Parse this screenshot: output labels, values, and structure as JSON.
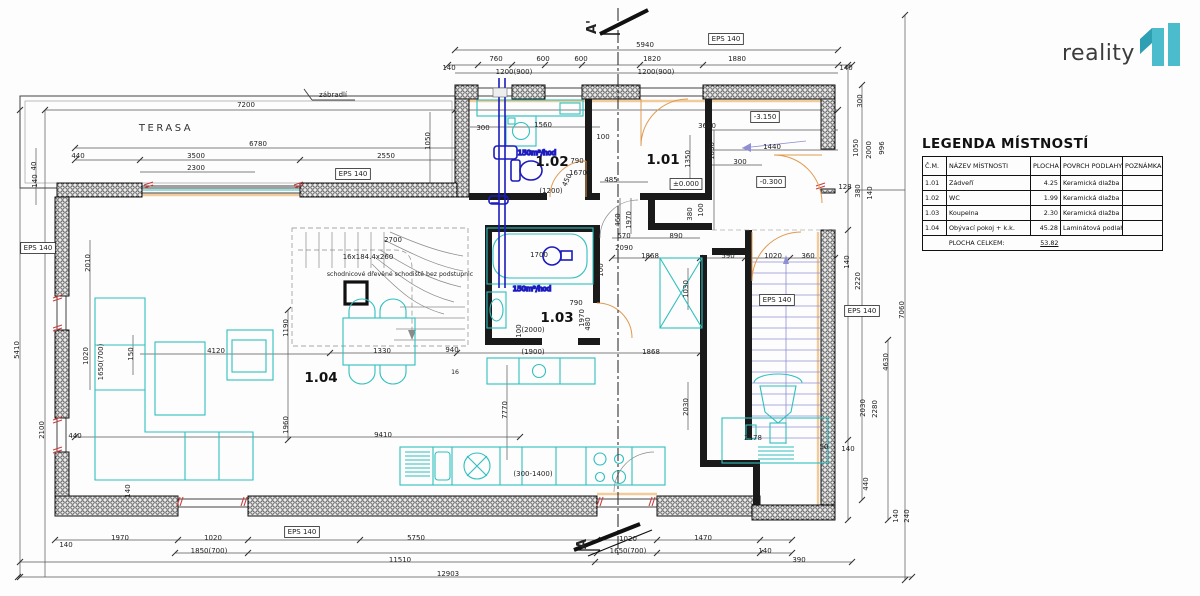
{
  "logo": {
    "text": "reality",
    "brand_color": "#4abccb",
    "flag_color": "#2f9fb4",
    "text_color": "#3c3c3c"
  },
  "legend": {
    "title": "LEGENDA MÍSTNOSTÍ",
    "headers": [
      "Č.M.",
      "NÁZEV MÍSTNOSTI",
      "PLOCHA [m2]",
      "POVRCH PODLAHY",
      "POZNÁMKA"
    ],
    "rows": [
      {
        "cm": "1.01",
        "nazev": "Zádveří",
        "plocha": "4.25",
        "povrch": "Keramická dlažba",
        "poznamka": ""
      },
      {
        "cm": "1.02",
        "nazev": "WC",
        "plocha": "1.99",
        "povrch": "Keramická dlažba",
        "poznamka": ""
      },
      {
        "cm": "1.03",
        "nazev": "Koupelna",
        "plocha": "2.30",
        "povrch": "Keramická dlažba",
        "poznamka": ""
      },
      {
        "cm": "1.04",
        "nazev": "Obývací pokoj + k.k.",
        "plocha": "45.28",
        "povrch": "Laminátová podlaha",
        "poznamka": ""
      }
    ],
    "total_label": "PLOCHA CELKEM:",
    "total_value": "53.82"
  },
  "annotations": [
    {
      "t": "A'",
      "x": 596,
      "y": 27,
      "rot": -90,
      "cls": "section",
      "name": "section-marker-label-top"
    },
    {
      "t": "A",
      "x": 586,
      "y": 544,
      "rot": -90,
      "cls": "section",
      "name": "section-marker-label-bottom"
    },
    {
      "t": "5940",
      "x": 645,
      "y": 47
    },
    {
      "t": "760",
      "x": 496,
      "y": 61
    },
    {
      "t": "600",
      "x": 543,
      "y": 61
    },
    {
      "t": "600",
      "x": 581,
      "y": 61
    },
    {
      "t": "1820",
      "x": 652,
      "y": 61
    },
    {
      "t": "1880",
      "x": 737,
      "y": 61
    },
    {
      "t": "140",
      "x": 449,
      "y": 70
    },
    {
      "t": "140",
      "x": 846,
      "y": 70
    },
    {
      "t": "1200(900)",
      "x": 514,
      "y": 74
    },
    {
      "t": "1200(900)",
      "x": 656,
      "y": 74
    },
    {
      "t": "EPS 140",
      "x": 726,
      "y": 41,
      "box": true,
      "name": "eps-label"
    },
    {
      "t": "7200",
      "x": 246,
      "y": 107
    },
    {
      "t": "zábradlí",
      "x": 333,
      "y": 97,
      "name": "railing-label"
    },
    {
      "t": "TERASA",
      "x": 166,
      "y": 131,
      "cls": "roomname",
      "name": "terrace-label"
    },
    {
      "t": "6780",
      "x": 258,
      "y": 146
    },
    {
      "t": "3500",
      "x": 196,
      "y": 158
    },
    {
      "t": "2300",
      "x": 196,
      "y": 170
    },
    {
      "t": "2550",
      "x": 386,
      "y": 158
    },
    {
      "t": "440",
      "x": 78,
      "y": 158
    },
    {
      "t": "40",
      "x": 36,
      "y": 166,
      "rot": -90
    },
    {
      "t": "EPS 140",
      "x": 353,
      "y": 176,
      "box": true,
      "name": "eps-label"
    },
    {
      "t": "1050",
      "x": 430,
      "y": 141,
      "rot": -90
    },
    {
      "t": "3620",
      "x": 707,
      "y": 128
    },
    {
      "t": "1050",
      "x": 714,
      "y": 151,
      "rot": -90
    },
    {
      "t": "1440",
      "x": 772,
      "y": 149
    },
    {
      "t": "300",
      "x": 740,
      "y": 164
    },
    {
      "t": "-3.150",
      "x": 765,
      "y": 119,
      "box": true,
      "name": "level-label"
    },
    {
      "t": "-0.300",
      "x": 771,
      "y": 184,
      "box": true,
      "name": "level-label"
    },
    {
      "t": "±0.000",
      "x": 686,
      "y": 186,
      "box": true,
      "name": "level-label"
    },
    {
      "t": "300",
      "x": 862,
      "y": 101,
      "rot": -90
    },
    {
      "t": "1050",
      "x": 858,
      "y": 148,
      "rot": -90
    },
    {
      "t": "2000",
      "x": 871,
      "y": 150,
      "rot": -90
    },
    {
      "t": "996",
      "x": 884,
      "y": 148,
      "rot": -90
    },
    {
      "t": "380",
      "x": 860,
      "y": 191,
      "rot": -90
    },
    {
      "t": "140",
      "x": 872,
      "y": 193,
      "rot": -90
    },
    {
      "t": "128",
      "x": 845,
      "y": 189
    },
    {
      "t": "140",
      "x": 849,
      "y": 262,
      "rot": -90
    },
    {
      "t": "2220",
      "x": 860,
      "y": 281,
      "rot": -90
    },
    {
      "t": "EPS 140",
      "x": 862,
      "y": 313,
      "box": true,
      "name": "eps-label"
    },
    {
      "t": "7060",
      "x": 904,
      "y": 310,
      "rot": -90
    },
    {
      "t": "4630",
      "x": 888,
      "y": 362,
      "rot": -90
    },
    {
      "t": "2030",
      "x": 865,
      "y": 408,
      "rot": -90
    },
    {
      "t": "2280",
      "x": 877,
      "y": 409,
      "rot": -90
    },
    {
      "t": "140",
      "x": 848,
      "y": 451
    },
    {
      "t": "440",
      "x": 868,
      "y": 484,
      "rot": -90
    },
    {
      "t": "140",
      "x": 898,
      "y": 516,
      "rot": -90
    },
    {
      "t": "240",
      "x": 909,
      "y": 516,
      "rot": -90
    },
    {
      "t": "300",
      "x": 483,
      "y": 130
    },
    {
      "t": "1560",
      "x": 543,
      "y": 127
    },
    {
      "t": "100",
      "x": 603,
      "y": 139
    },
    {
      "t": "1.02",
      "x": 552,
      "y": 166,
      "cls": "room",
      "name": "room-label-1-02"
    },
    {
      "t": "790",
      "x": 577,
      "y": 163
    },
    {
      "t": "1670",
      "x": 578,
      "y": 175
    },
    {
      "t": "485",
      "x": 611,
      "y": 182
    },
    {
      "t": "450",
      "x": 569,
      "y": 181,
      "rot": -65
    },
    {
      "t": "(1200)",
      "x": 551,
      "y": 193
    },
    {
      "t": "1.01",
      "x": 663,
      "y": 164,
      "cls": "room",
      "name": "room-label-1-01"
    },
    {
      "t": "1350",
      "x": 690,
      "y": 159,
      "rot": -90
    },
    {
      "t": "460",
      "x": 620,
      "y": 220,
      "rot": -90
    },
    {
      "t": "1970",
      "x": 631,
      "y": 220,
      "rot": -90
    },
    {
      "t": "570",
      "x": 624,
      "y": 238
    },
    {
      "t": "2090",
      "x": 624,
      "y": 250
    },
    {
      "t": "890",
      "x": 676,
      "y": 238
    },
    {
      "t": "380",
      "x": 692,
      "y": 214,
      "rot": -90
    },
    {
      "t": "100",
      "x": 703,
      "y": 210,
      "rot": -90
    },
    {
      "t": "1868",
      "x": 650,
      "y": 258
    },
    {
      "t": "590",
      "x": 728,
      "y": 258
    },
    {
      "t": "1020",
      "x": 773,
      "y": 258
    },
    {
      "t": "360",
      "x": 808,
      "y": 258
    },
    {
      "t": "1030",
      "x": 688,
      "y": 289,
      "rot": -90
    },
    {
      "t": "100",
      "x": 603,
      "y": 270,
      "rot": -90
    },
    {
      "t": "EPS 140",
      "x": 777,
      "y": 302,
      "box": true,
      "name": "eps-label"
    },
    {
      "t": "1700",
      "x": 539,
      "y": 257
    },
    {
      "t": "150m³/hod",
      "x": 537,
      "y": 155,
      "cls": "blue",
      "name": "vent-label-wc"
    },
    {
      "t": "150m³/hod",
      "x": 532,
      "y": 291,
      "cls": "blue",
      "name": "vent-label-bath"
    },
    {
      "t": "1.03",
      "x": 557,
      "y": 322,
      "cls": "room",
      "name": "room-label-1-03"
    },
    {
      "t": "790",
      "x": 576,
      "y": 305
    },
    {
      "t": "1970",
      "x": 584,
      "y": 318,
      "rot": -90
    },
    {
      "t": "480",
      "x": 590,
      "y": 324,
      "rot": -90
    },
    {
      "t": "(2000)",
      "x": 533,
      "y": 332
    },
    {
      "t": "100",
      "x": 521,
      "y": 331,
      "rot": -90
    },
    {
      "t": "2700",
      "x": 393,
      "y": 242
    },
    {
      "t": "16x184.4x260",
      "x": 368,
      "y": 259
    },
    {
      "t": "schodnicové dřevěné schodiště bez podstupnic",
      "x": 400,
      "y": 276,
      "cls": "small",
      "name": "stair-note"
    },
    {
      "t": "1330",
      "x": 382,
      "y": 353
    },
    {
      "t": "940",
      "x": 452,
      "y": 352
    },
    {
      "t": "16",
      "x": 455,
      "y": 374,
      "cls": "small"
    },
    {
      "t": "1.04",
      "x": 321,
      "y": 382,
      "cls": "room",
      "name": "room-label-1-04"
    },
    {
      "t": "4120",
      "x": 216,
      "y": 353
    },
    {
      "t": "150",
      "x": 133,
      "y": 354,
      "rot": -90
    },
    {
      "t": "1190",
      "x": 288,
      "y": 328,
      "rot": -90
    },
    {
      "t": "1960",
      "x": 288,
      "y": 425,
      "rot": -90
    },
    {
      "t": "(1900)",
      "x": 533,
      "y": 354
    },
    {
      "t": "1868",
      "x": 651,
      "y": 354
    },
    {
      "t": "7770",
      "x": 507,
      "y": 410,
      "rot": -90
    },
    {
      "t": "2030",
      "x": 688,
      "y": 407,
      "rot": -90
    },
    {
      "t": "9410",
      "x": 383,
      "y": 437
    },
    {
      "t": "(300-1400)",
      "x": 533,
      "y": 476
    },
    {
      "t": "2478",
      "x": 753,
      "y": 440
    },
    {
      "t": "50",
      "x": 824,
      "y": 449
    },
    {
      "t": "440",
      "x": 75,
      "y": 438
    },
    {
      "t": "140",
      "x": 37,
      "y": 181,
      "rot": -90
    },
    {
      "t": "EPS 140",
      "x": 38,
      "y": 250,
      "box": true,
      "name": "eps-label"
    },
    {
      "t": "2010",
      "x": 90,
      "y": 263,
      "rot": -90
    },
    {
      "t": "5410",
      "x": 19,
      "y": 350,
      "rot": -90
    },
    {
      "t": "1020",
      "x": 88,
      "y": 356,
      "rot": -90
    },
    {
      "t": "1650(700)",
      "x": 103,
      "y": 362,
      "rot": -90
    },
    {
      "t": "2100",
      "x": 44,
      "y": 430,
      "rot": -90
    },
    {
      "t": "140",
      "x": 130,
      "y": 491,
      "rot": -90
    },
    {
      "t": "140",
      "x": 66,
      "y": 547
    },
    {
      "t": "1970",
      "x": 120,
      "y": 540
    },
    {
      "t": "1020",
      "x": 213,
      "y": 540
    },
    {
      "t": "1850(700)",
      "x": 209,
      "y": 553
    },
    {
      "t": "EPS 140",
      "x": 302,
      "y": 534,
      "box": true,
      "name": "eps-label"
    },
    {
      "t": "5750",
      "x": 416,
      "y": 540
    },
    {
      "t": "11510",
      "x": 400,
      "y": 562
    },
    {
      "t": "1020",
      "x": 628,
      "y": 541
    },
    {
      "t": "1470",
      "x": 703,
      "y": 540
    },
    {
      "t": "1650(700)",
      "x": 628,
      "y": 553
    },
    {
      "t": "140",
      "x": 765,
      "y": 553
    },
    {
      "t": "390",
      "x": 799,
      "y": 562
    },
    {
      "t": "12903",
      "x": 448,
      "y": 576
    }
  ]
}
